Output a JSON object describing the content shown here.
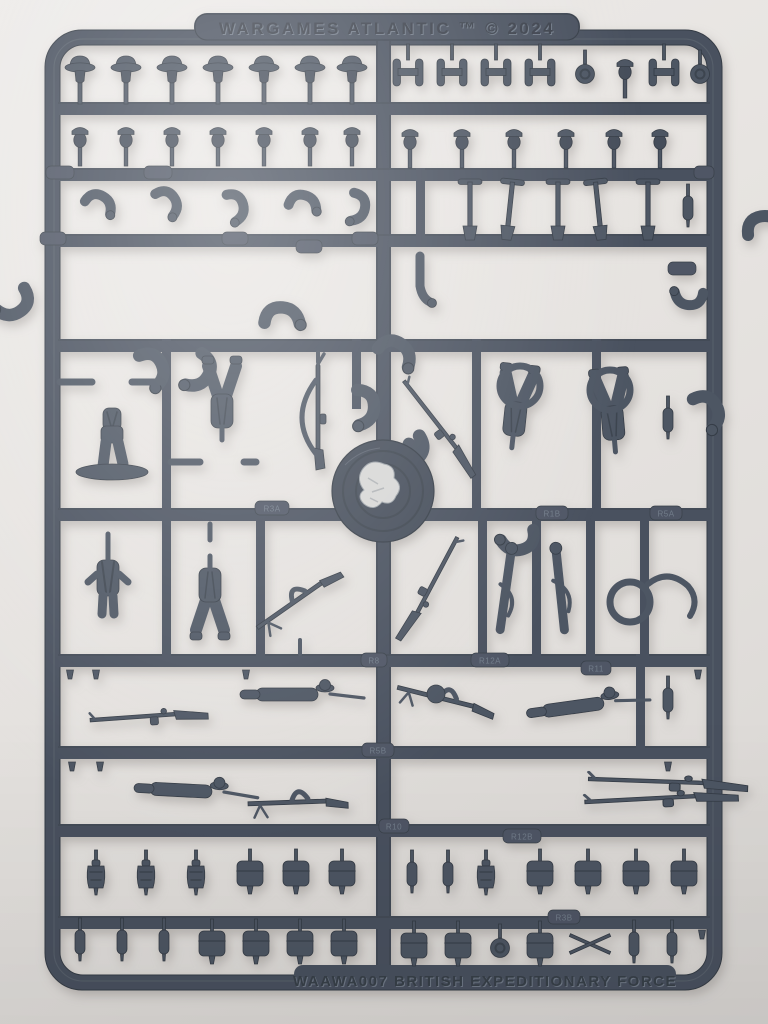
{
  "sprue": {
    "top_text": "WARGAMES ATLANTIC ™ © 2024",
    "bottom_text": "WAAWA007 BRITISH EXPEDITIONARY FORCE",
    "part_labels": {
      "r3a": "R3A",
      "r1b": "R1B",
      "r5a": "R5A",
      "r8": "R8",
      "r12a": "R12A",
      "r11": "R11",
      "r5b": "R5B",
      "r10": "R10",
      "r12b": "R12B",
      "r3b": "R3B"
    },
    "colors": {
      "plastic": "#49515e",
      "plastic_shadow": "#353c46",
      "plastic_highlight": "#6d7684",
      "background": "#e7e4e1",
      "injection_scrape": "#d7d7d6"
    },
    "parts": {
      "row1_left": "brodie-helmet-heads",
      "row1_right": "tool-handle-parts",
      "row2": "heads-with-field-caps",
      "row3_left": "bent-arms",
      "row3_right": "entrenching-tools",
      "row4": "arm-pairs",
      "middle": "torsos-legs-and-slung-rifles",
      "hub": "central-injection-hub",
      "weapon_rows": "rifles-and-bren-guns",
      "bottom_rows": "pouches-water-bottles-and-kit"
    }
  }
}
